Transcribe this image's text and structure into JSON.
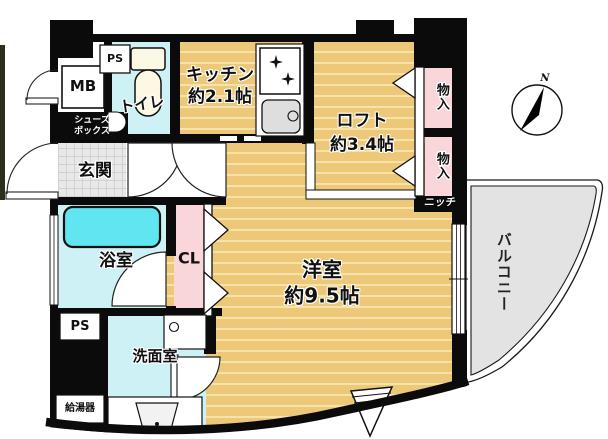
{
  "floorplan": {
    "rooms": {
      "kitchen": {
        "name_line": "キッチン",
        "size_line": "約2.1帖"
      },
      "loft": {
        "name_line": "ロフト",
        "size_line": "約3.4帖"
      },
      "western_room": {
        "name_line": "洋室",
        "size_line": "約9.5帖"
      },
      "toilet": {
        "label": "トイレ"
      },
      "entrance": {
        "label": "玄関"
      },
      "bathroom": {
        "label": "浴室"
      },
      "washroom": {
        "label": "洗面室"
      },
      "balcony": {
        "label": "バルコニー"
      },
      "closet": {
        "label": "CL"
      },
      "storage_upper": {
        "label": "物入"
      },
      "storage_lower": {
        "label": "物入"
      },
      "meter_box": {
        "label": "MB"
      },
      "pipe_space_top": {
        "label": "PS"
      },
      "pipe_space_bottom": {
        "label": "PS"
      },
      "shoe_box": {
        "line1": "シューズ",
        "line2": "ボックス"
      },
      "niche": {
        "label": "ニッチ"
      },
      "water_heater": {
        "label": "給湯器"
      }
    },
    "compass": {
      "north_label": "N"
    },
    "colors": {
      "wood_floor": "#ecc878",
      "wood_stripe": "#f6e3ab",
      "wet_room_floor": "#cdf1f5",
      "bathtub": "#5fe6f0",
      "closet_pink": "#f8d6da",
      "entrance_floor": "#e8e8e8",
      "balcony_gray": "#e3e3e3",
      "wall": "#0b0b0b"
    }
  }
}
